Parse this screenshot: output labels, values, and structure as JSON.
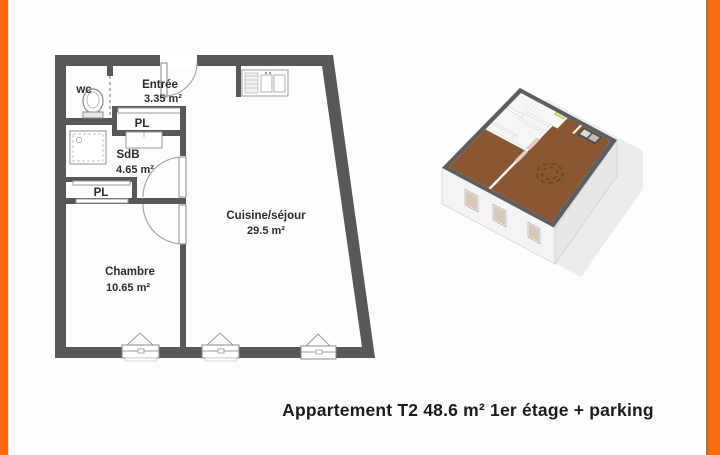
{
  "caption": "Appartement T2 48.6 m² 1er étage + parking",
  "floor_plan": {
    "rooms": {
      "wc": {
        "name": "wc"
      },
      "entree": {
        "name": "Entrée",
        "area": "3.35 m²"
      },
      "pl1": {
        "name": "PL"
      },
      "sdb": {
        "name": "SdB",
        "area": "4.65 m²"
      },
      "pl2": {
        "name": "PL"
      },
      "cuisine": {
        "name": "Cuisine/séjour",
        "area": "29.5 m²"
      },
      "chambre": {
        "name": "Chambre",
        "area": "10.65 m²"
      }
    },
    "fixtures": [
      "toilet-icon",
      "shower-icon",
      "washbasin-icon",
      "kitchen-sink-icon"
    ],
    "window_count": 3
  },
  "colors": {
    "accent_orange": "#F96A0C",
    "wall_gray": "#58585A",
    "floor_brown": "#8A5732",
    "door_green": "#D2EE82",
    "caption_text": "#1C1C1C"
  }
}
